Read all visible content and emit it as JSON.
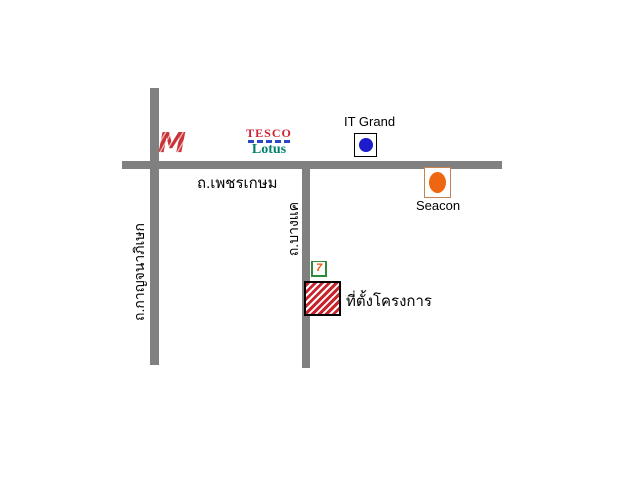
{
  "map": {
    "background_color": "#ffffff",
    "road_color": "#808080",
    "roads": {
      "phetkasem": {
        "label": "ถ.เพชรเกษม",
        "orientation": "horizontal"
      },
      "kanchanaphisek": {
        "label": "ถ.กาญจนาภิเษก",
        "orientation": "vertical"
      },
      "bangkhae": {
        "label": "ถ.บางแค",
        "orientation": "vertical"
      }
    },
    "landmarks": {
      "the_mall": {
        "glyph": "M",
        "color": "#c8333a",
        "stripe_color": "#f0b4b4"
      },
      "tesco_lotus": {
        "line1": "TESCO",
        "line2": "Lotus",
        "red": "#cc2233",
        "dash_blue": "#2c46c8",
        "green": "#00806c"
      },
      "it_grand": {
        "label": "IT Grand",
        "dot_color": "#1c1ccc",
        "box_border": "#000000"
      },
      "seacon": {
        "label": "Seacon",
        "dot_color": "#ee6611",
        "box_border": "#c8824f"
      },
      "seven_eleven": {
        "glyph": "7",
        "green": "#2e8b3a",
        "orange": "#e8550f"
      },
      "project_site": {
        "label": "ที่ตั้งโครงการ",
        "hatch_color": "#c8262e",
        "border_color": "#000000"
      }
    }
  }
}
